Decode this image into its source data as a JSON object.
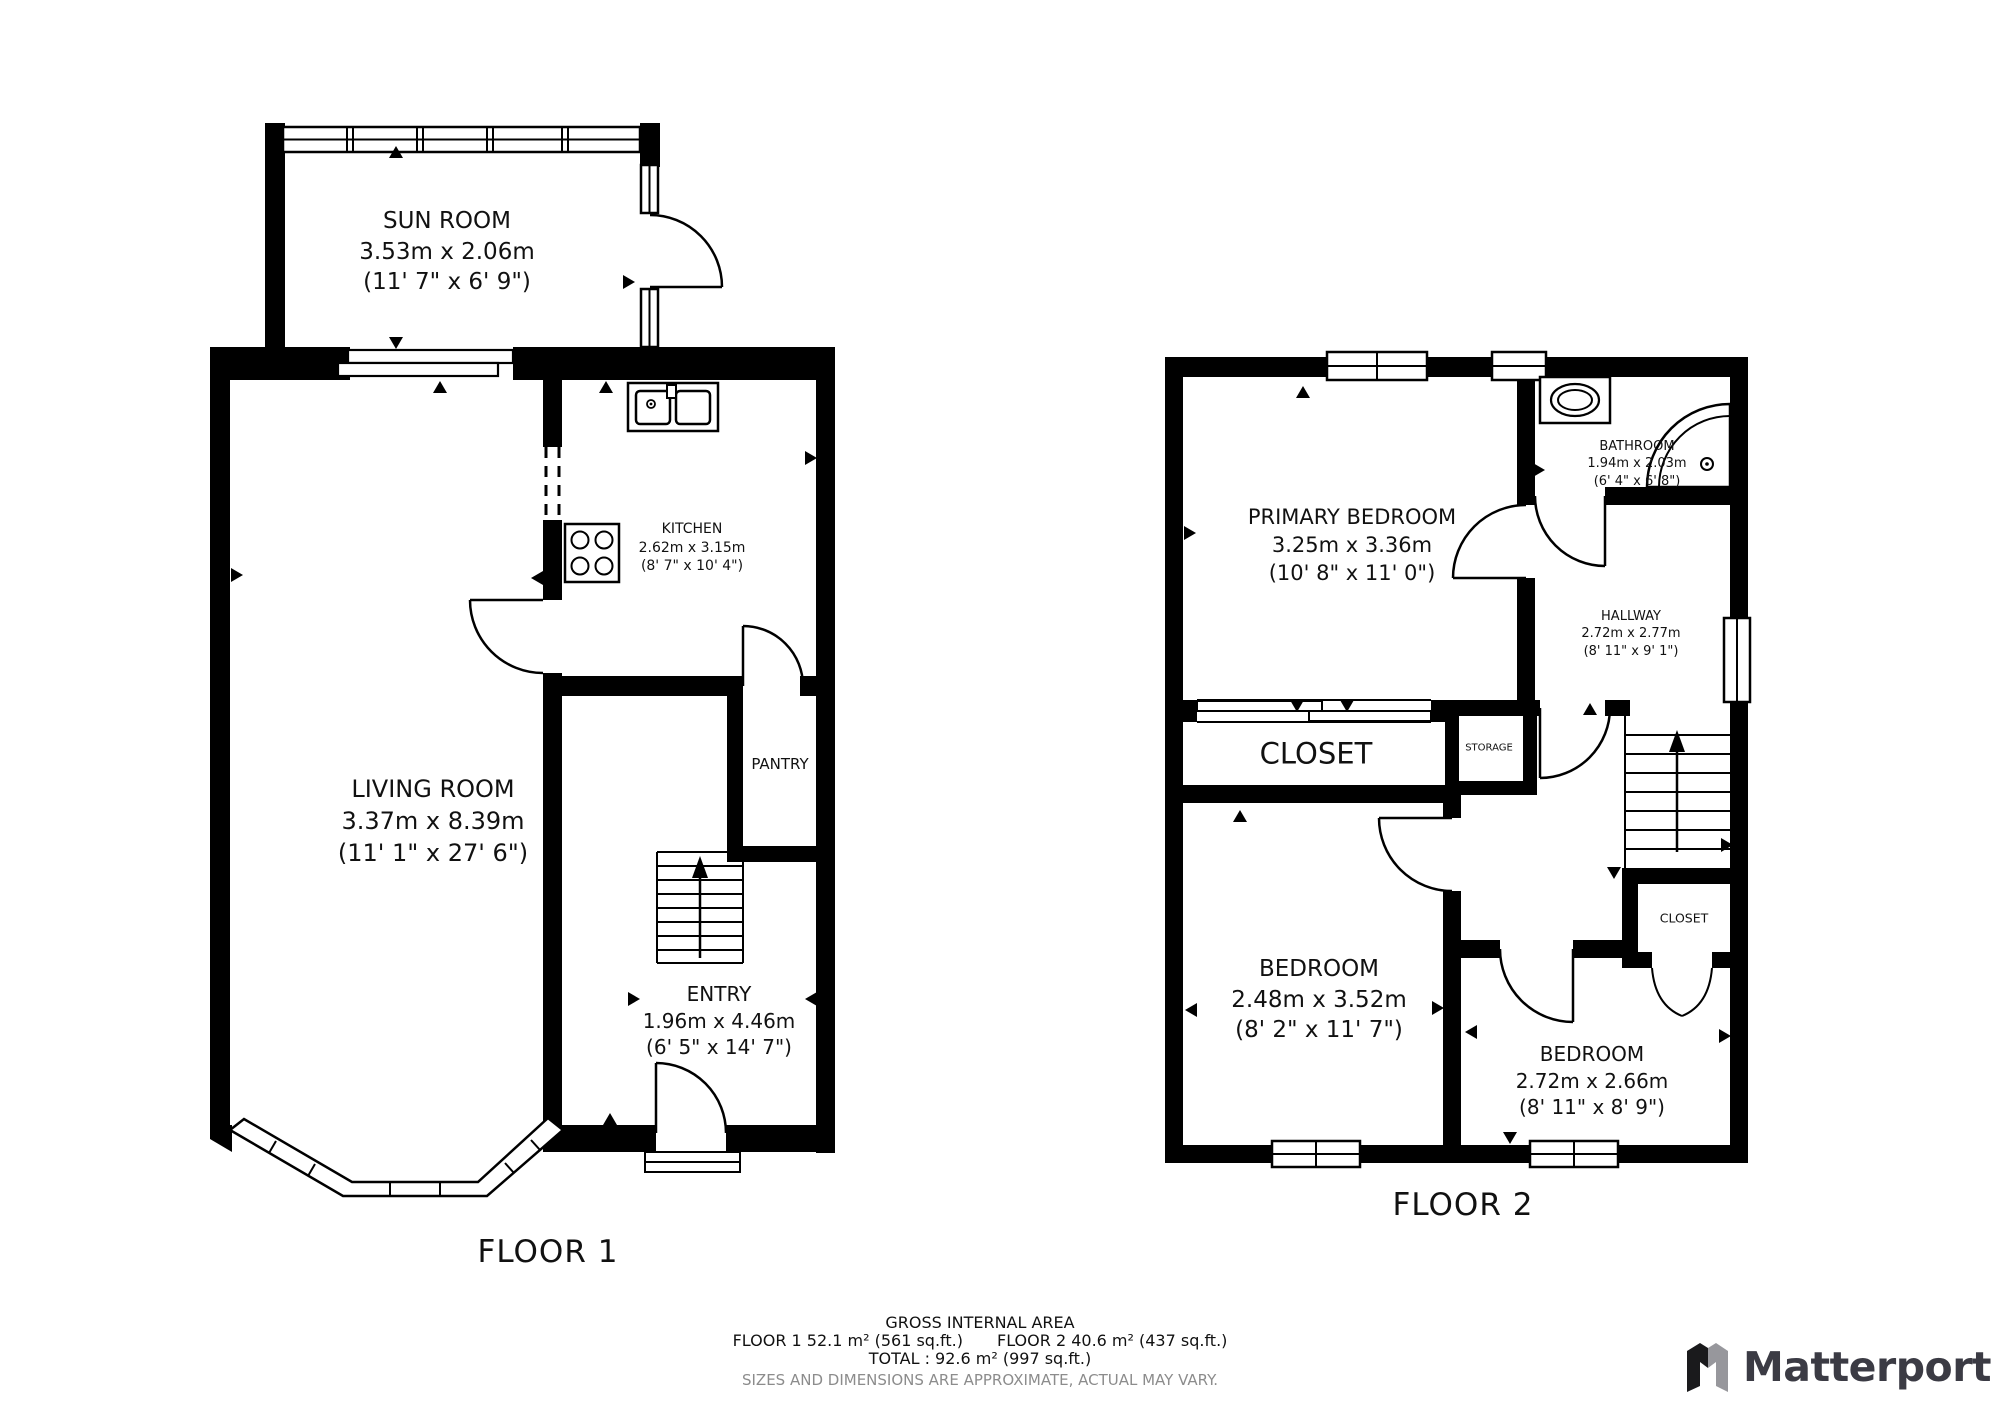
{
  "floor1": {
    "title": "FLOOR 1",
    "rooms": {
      "sun_room": {
        "name": "SUN ROOM",
        "metric": "3.53m x 2.06m",
        "imperial": "(11' 7\" x 6' 9\")"
      },
      "kitchen": {
        "name": "KITCHEN",
        "metric": "2.62m x 3.15m",
        "imperial": "(8' 7\" x 10' 4\")"
      },
      "living_room": {
        "name": "LIVING ROOM",
        "metric": "3.37m x 8.39m",
        "imperial": "(11' 1\" x 27' 6\")"
      },
      "pantry": {
        "name": "PANTRY"
      },
      "entry": {
        "name": "ENTRY",
        "metric": "1.96m x 4.46m",
        "imperial": "(6' 5\" x 14' 7\")"
      }
    }
  },
  "floor2": {
    "title": "FLOOR 2",
    "rooms": {
      "primary_bedroom": {
        "name": "PRIMARY BEDROOM",
        "metric": "3.25m x 3.36m",
        "imperial": "(10' 8\" x 11' 0\")"
      },
      "bathroom": {
        "name": "BATHROOM",
        "metric": "1.94m x 2.03m",
        "imperial": "(6' 4\" x 6' 8\")"
      },
      "hallway": {
        "name": "HALLWAY",
        "metric": "2.72m x 2.77m",
        "imperial": "(8' 11\" x 9' 1\")"
      },
      "closet": {
        "name": "CLOSET"
      },
      "storage": {
        "name": "STORAGE"
      },
      "bedroom_left": {
        "name": "BEDROOM",
        "metric": "2.48m x 3.52m",
        "imperial": "(8' 2\" x 11' 7\")"
      },
      "bedroom_right": {
        "name": "BEDROOM",
        "metric": "2.72m x 2.66m",
        "imperial": "(8' 11\" x 8' 9\")"
      },
      "closet_small": {
        "name": "CLOSET"
      }
    }
  },
  "footer": {
    "gross_title": "GROSS INTERNAL AREA",
    "floor1_area": "FLOOR 1 52.1 m² (561 sq.ft.)",
    "floor2_area": "FLOOR 2 40.6 m² (437 sq.ft.)",
    "total_line": "TOTAL :  92.6 m² (997 sq.ft.)",
    "disclaimer": "SIZES AND DIMENSIONS ARE APPROXIMATE, ACTUAL MAY VARY.",
    "disclaimer_color": "#8c8c8c"
  },
  "branding": {
    "logo_text": "Matterport",
    "logo_color": "#3b3b44",
    "icon_black": "#1a1a1c",
    "icon_gray": "#97979c"
  }
}
